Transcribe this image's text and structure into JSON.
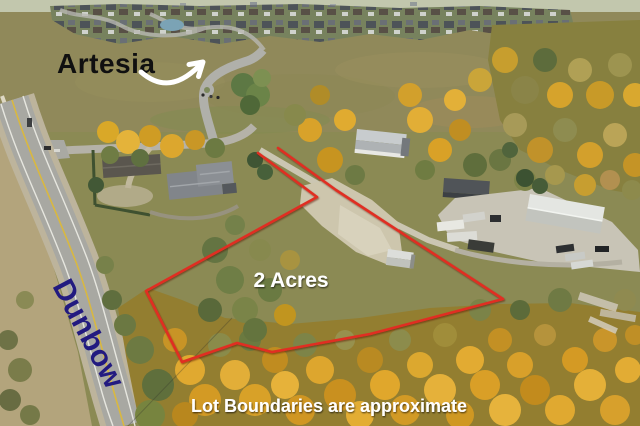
{
  "labels": {
    "neighbourhood": "Artesia",
    "road": "Dunbow",
    "lot_size": "2 Acres",
    "disclaimer": "Lot Boundaries are approximate"
  },
  "colors": {
    "boundary_red": "#e02f22",
    "road_label_blue": "#221a80",
    "neighbourhood_label_black": "#101010",
    "annotation_white": "#ffffff"
  }
}
